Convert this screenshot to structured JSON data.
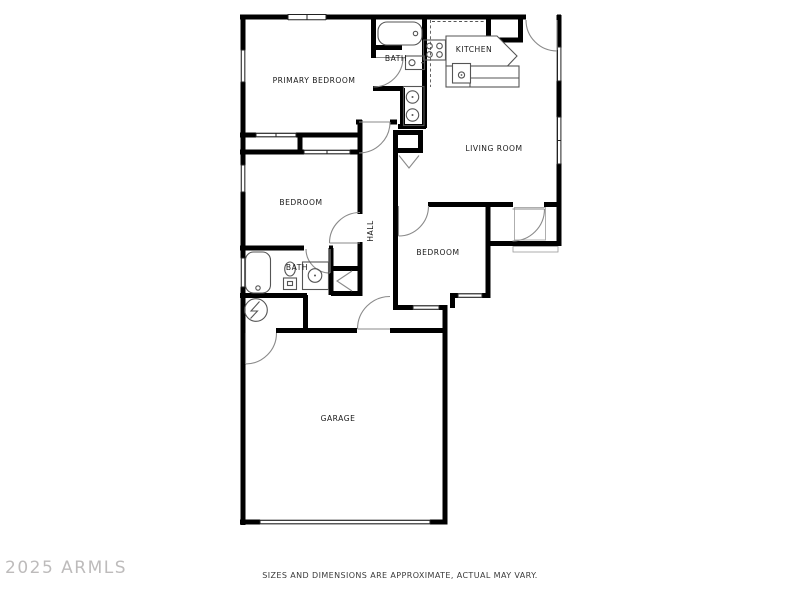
{
  "footer": {
    "watermark": "2025 ARMLS",
    "disclaimer": "SIZES AND DIMENSIONS ARE APPROXIMATE, ACTUAL MAY VARY."
  },
  "colors": {
    "background": "#ffffff",
    "wall": "#000000",
    "door": "#8a8a8a",
    "fixture": "#555555",
    "winline": "#222222",
    "thin": "#9a9a9a",
    "label": "#1a1a1a",
    "watermark": "#b2b0b0",
    "disclaimer": "#3a3a3a"
  },
  "rooms": {
    "primary_bedroom": {
      "label": "PRIMARY BEDROOM"
    },
    "primary_bath": {
      "label": "BATH"
    },
    "kitchen": {
      "label": "KITCHEN"
    },
    "living_room": {
      "label": "LIVING ROOM"
    },
    "bedroom_left": {
      "label": "BEDROOM"
    },
    "hall": {
      "label": "HALL"
    },
    "bedroom_right": {
      "label": "BEDROOM"
    },
    "bath": {
      "label": "BATH"
    },
    "garage": {
      "label": "GARAGE"
    }
  }
}
